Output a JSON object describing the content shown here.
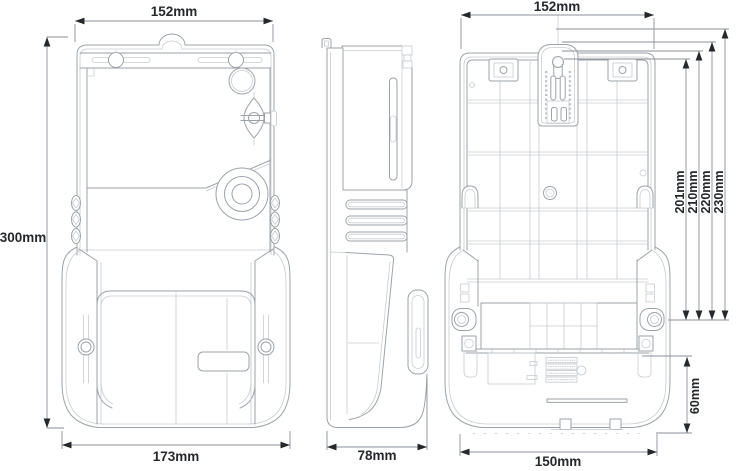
{
  "drawing": {
    "colors": {
      "background": "#ffffff",
      "linework": "#9ba3aa",
      "linework_faint": "#c6ccd2",
      "dimension_line": "#8a9199",
      "dimension_text": "#25282c"
    },
    "views": {
      "front": {
        "width_top": "152mm",
        "height": "300mm",
        "width_bottom": "173mm"
      },
      "side": {
        "depth": "78mm"
      },
      "back": {
        "width_top": "152mm",
        "mount_heights": [
          "201mm",
          "210mm",
          "220mm",
          "230mm"
        ],
        "terminal_offset": "60mm",
        "width_bottom": "150mm"
      }
    }
  }
}
